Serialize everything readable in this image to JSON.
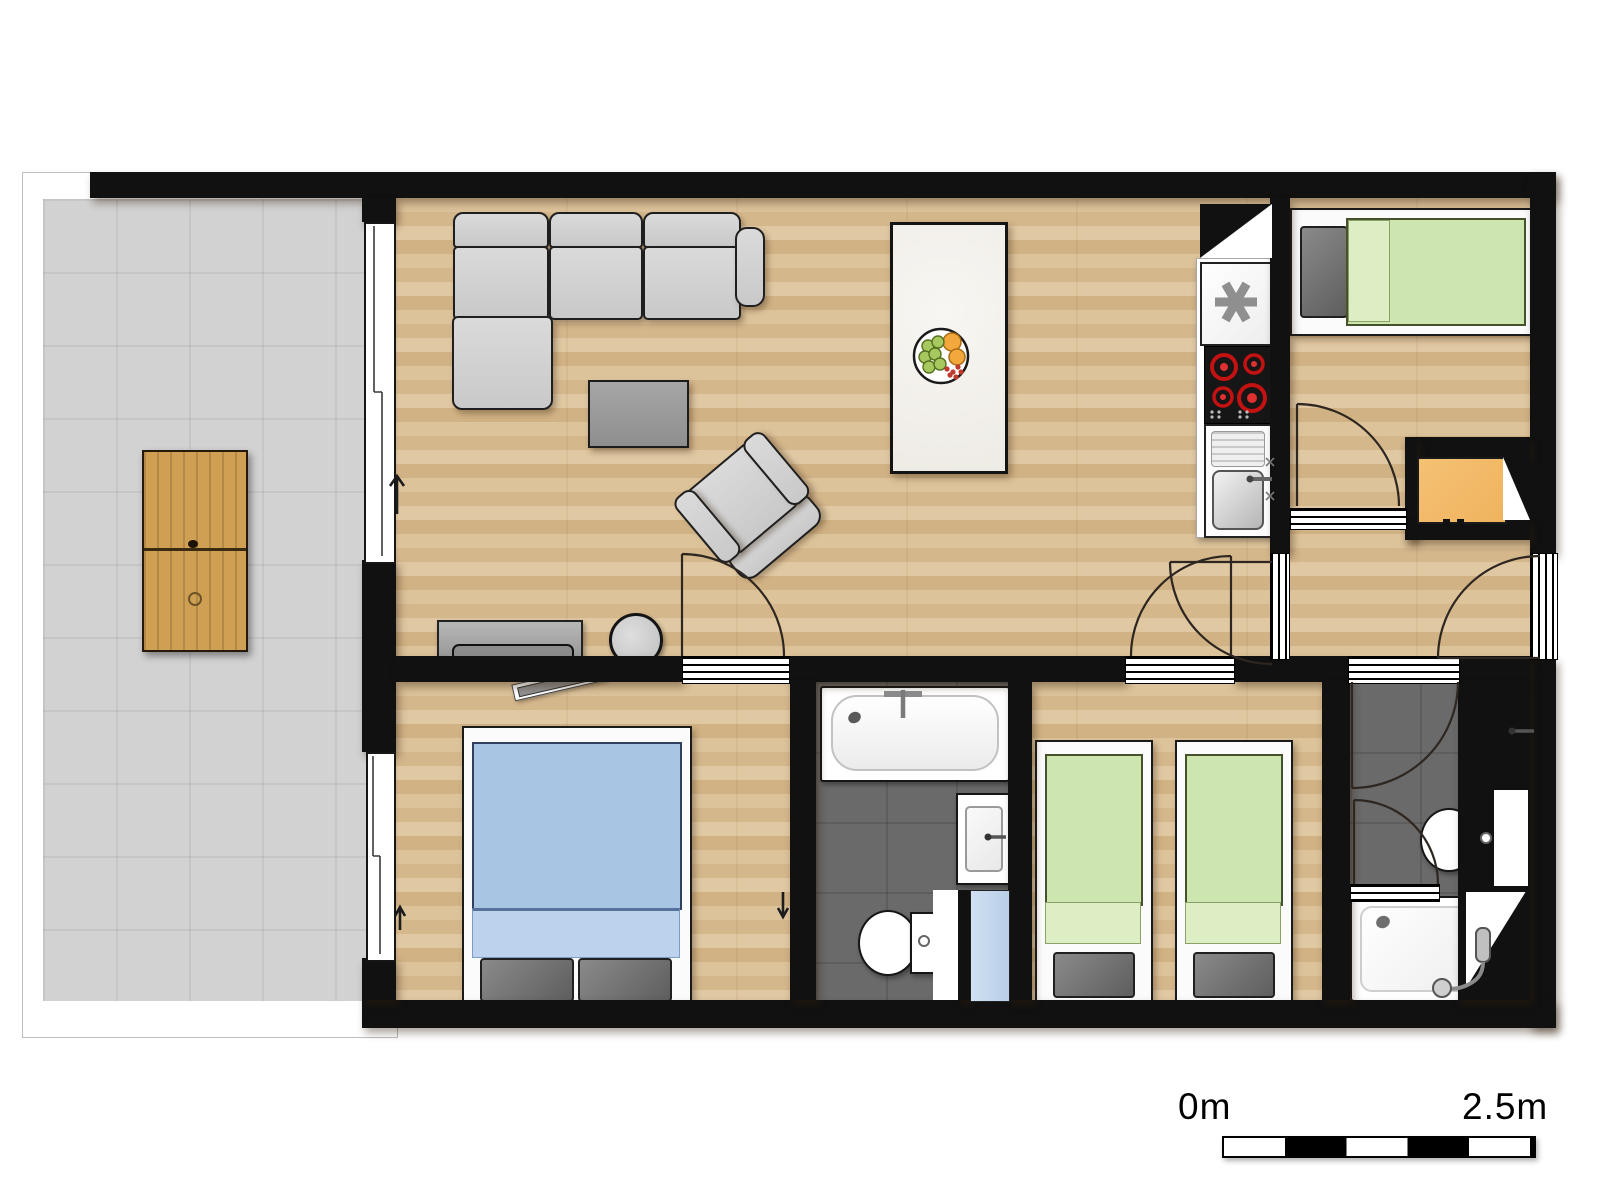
{
  "scale_bar": {
    "start_label": "0m",
    "end_label": "2.5m",
    "segments": 5
  },
  "palette": {
    "wall": "#111111",
    "tile": "#d2d2d2",
    "bath_floor": "#6a6a6a",
    "blanket_green": "#cde5af",
    "blanket_blue": "#a9c5e4",
    "desk_orange": "#f0b35e",
    "outdoor_wood": "#cf9f53",
    "burner_red": "#cc1414",
    "niche_blue": "#b9cfe7"
  },
  "rooms": [
    {
      "name": "terrace",
      "floor": "tile",
      "furniture": [
        "outdoor-dining-table",
        "outdoor-chair x6"
      ]
    },
    {
      "name": "living-dining-kitchen",
      "floor": "wood",
      "furniture": [
        "corner-sofa",
        "coffee-table",
        "armchair",
        "side-table",
        "tv-sideboard",
        "dining-table",
        "dining-chair x6",
        "fruit-bowl",
        "fridge-freezer",
        "cooktop-4-burners",
        "kitchen-sink"
      ]
    },
    {
      "name": "bedroom-top-right",
      "floor": "wood",
      "furniture": [
        "single-bed-green"
      ]
    },
    {
      "name": "hallway",
      "floor": "wood",
      "furniture": [
        "desk-orange"
      ],
      "doors": [
        "entrance-door"
      ]
    },
    {
      "name": "bedroom-bottom-left",
      "floor": "wood",
      "furniture": [
        "double-bed-blue",
        "wall-tv"
      ]
    },
    {
      "name": "bathroom-main",
      "floor": "dark-tile",
      "fixtures": [
        "bathtub",
        "washbasin",
        "toilet",
        "blue-niche"
      ]
    },
    {
      "name": "bedroom-twin",
      "floor": "wood",
      "furniture": [
        "single-bed-green",
        "single-bed-green"
      ]
    },
    {
      "name": "bathroom-ensuite",
      "floor": "dark-tile",
      "fixtures": [
        "washbasin",
        "toilet",
        "shower-tray"
      ]
    }
  ]
}
